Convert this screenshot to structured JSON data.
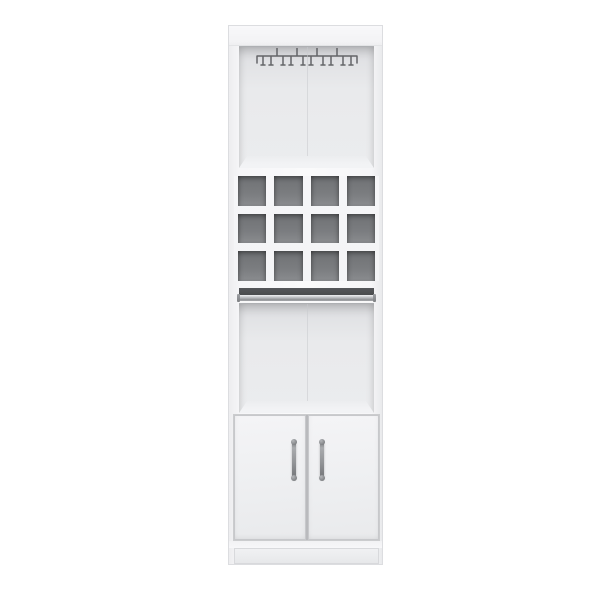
{
  "scene": {
    "kind": "product-photo",
    "subject": "tall white bar cabinet with hanging stemware rack, 12 wine cubbies, serving rail, open shelf and two-door storage",
    "background": "#ffffff"
  },
  "cabinet": {
    "finish": "white",
    "sections": [
      "top open compartment with stemware rack",
      "wine cubby rack",
      "serving rail",
      "open shelf compartment",
      "two-door cabinet",
      "plinth base"
    ],
    "stemware_rack": {
      "color": "#56585b",
      "posts": 4,
      "prong_pairs": 5
    },
    "wine_rack": {
      "rows": 3,
      "columns": 4,
      "cubby_count": 12
    },
    "doors": {
      "count": 2,
      "handle_count": 2
    }
  },
  "theme": {
    "background": "#ffffff",
    "edge": "#dcdde0",
    "interior_top": "#dddee1",
    "interior": "#e9eaec",
    "interior_floor": "#f2f3f5",
    "seam": "#c9cacd",
    "divider": "#f3f4f6",
    "cubby": "#7b7d80",
    "cubby_light": "#8a8c8f",
    "recess": "#4a4c4e",
    "rail_light": "#f0f1f3",
    "rail_mid": "#b9bbbe",
    "rail_dark": "#8f9194",
    "door_face_a": "#f4f4f6",
    "door_face_b": "#e9eaec",
    "door_edge": "#c7c8cb",
    "handle_light": "#a9abae",
    "handle_dark": "#6d6f72",
    "metal": "#56585b",
    "plinth": "#f0f1f3"
  }
}
